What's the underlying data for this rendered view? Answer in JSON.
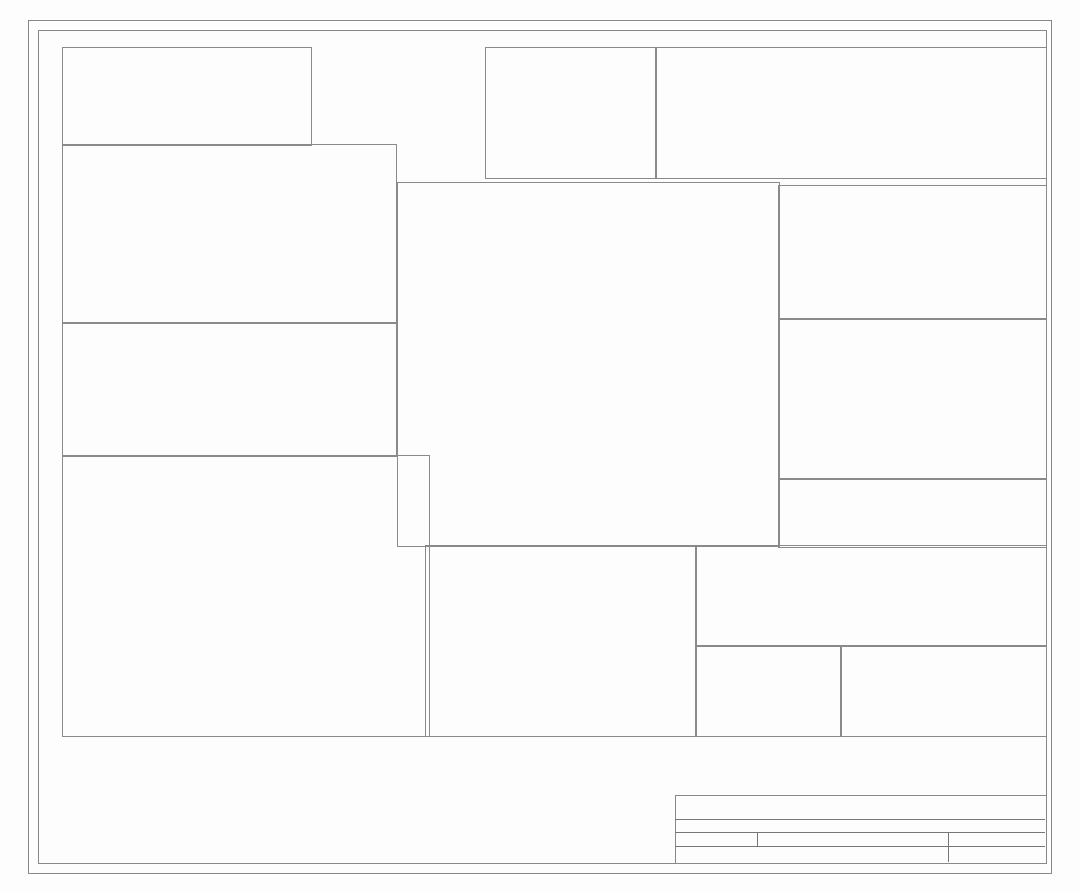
{
  "frame": {
    "cols": [
      "1",
      "2",
      "3",
      "4",
      "5",
      "6"
    ],
    "rows": [
      "A",
      "B",
      "C",
      "D",
      "E"
    ]
  },
  "title_block": {
    "sheet": "Sheet: /",
    "file": "File: STM32Duino开发板-G431Rx.kicad_sch",
    "title": "Title:",
    "size": "Size: User",
    "date": "Date:",
    "rev": "Rev:",
    "app": "KiCad E.D.A. 9.0.2",
    "id": "Id: 1/1"
  },
  "crystal": {
    "title": "晶振",
    "gnd": "GND",
    "c1": "C1",
    "c1v": "10pF",
    "osc_in": "OSC_IN",
    "x1": "X1",
    "x1v": "8MHz",
    "c2": "C2",
    "c2v": "10pF",
    "osc_out": "OSC_OUT",
    "c22": "C22",
    "c22v": "15pF",
    "osc32_in": "OSC32_IN",
    "x2": "X2",
    "x2v": "32.768kHz",
    "c23": "C23",
    "c23v": "15pF",
    "osc32_out": "OSC32_OUT"
  },
  "fuse": {
    "title": "电源保险丝",
    "vbus": "VBUS",
    "f1": "F1",
    "vusb": "VUSB"
  },
  "power": {
    "title": "电源部分",
    "dc2": "DC2",
    "p1": "1",
    "p3": "3",
    "p2": "2",
    "vin": "VIN",
    "d6": "D6",
    "vcc": "VCC",
    "c32": "C32",
    "c32v": "47uF",
    "u12": "U12",
    "u12pins": "VIN VOUT ADJ/GND",
    "n321": "3 2 1",
    "gnd": "GND",
    "pwr1": "PWR1",
    "r20": "R20",
    "r20v": "1.2kΩ",
    "p5v": "+5V",
    "c33": "C33",
    "c33v": "100nF",
    "c34": "C34",
    "c34v": "47uF",
    "c35": "C35",
    "c35v": "100nF",
    "c17": "C17",
    "c17v": "10uF",
    "c9": "C9",
    "c9v": "100nF",
    "q1": "Q1",
    "c18": "C18",
    "c18v": "10uF",
    "c13": "C13",
    "c13v": "100nF",
    "p33": "+3.3V"
  },
  "rf": {
    "title": "参考电压滤波",
    "p33": "+3.3V",
    "l1": "L1",
    "l1v": "10uH",
    "aref": "AREF",
    "c47": "C47",
    "c47v": "100nF",
    "u17": "U17",
    "p2": "2",
    "c3": "C3",
    "c3v": "100nF",
    "c40": "C40",
    "c40v": "1uF",
    "c41": "C41",
    "c41v": "1uF",
    "c42": "C42",
    "c42v": "100nF",
    "gnda": "GNDA",
    "l2": "L2",
    "l2v": "10uH",
    "c46": "C46",
    "c46v": "100nF",
    "gnd": "GND",
    "avdd": "AVDD",
    "r30": "R30"
  },
  "mf": {
    "title": "MCU滤波",
    "p33": "+3.3V",
    "gnd": "GND",
    "refs": [
      "C48",
      "C19",
      "C37",
      "C38",
      "C39",
      "C43",
      "C44"
    ],
    "vals": [
      "1uF",
      "10uF",
      "100nF",
      "100nF",
      "100nF",
      "100nF",
      "100nF"
    ]
  },
  "mcu": {
    "title": "MCU",
    "ref": "U16",
    "part": "STM32G431RBT6",
    "p33": "+3.3V",
    "left": [
      [
        "1",
        "VBAT",
        "",
        ""
      ],
      [
        "2",
        "PC13",
        "PC13",
        "p"
      ],
      [
        "3",
        "PC14-OSC32_IN",
        "OSC32_IN",
        "p"
      ],
      [
        "4",
        "PC15-OSC32_OUT",
        "OSC32_OUT",
        "p"
      ],
      [
        "5",
        "PF0-OSC_IN",
        "OSC_IN",
        "p"
      ],
      [
        "6",
        "PF1-OSC_OUT",
        "OSC_OUT",
        "p"
      ],
      [
        "7",
        "PG10-NRST",
        "RESET",
        "p"
      ],
      [
        "8",
        "PC0",
        "A0",
        "p"
      ],
      [
        "9",
        "PC1",
        "A1",
        "p"
      ],
      [
        "10",
        "PC2",
        "A2",
        "p"
      ],
      [
        "11",
        "PC3",
        "A3",
        "p"
      ],
      [
        "12",
        "PA0",
        "A4",
        "p"
      ],
      [
        "13",
        "PA1",
        "A5",
        "p"
      ],
      [
        "14",
        "PA2",
        "D1",
        "p"
      ],
      [
        "15",
        "VSS",
        "GND",
        "w"
      ],
      [
        "16",
        "VDD",
        "+3.3V",
        "w"
      ],
      [
        "17",
        "PA3",
        "D0",
        "p"
      ],
      [
        "18",
        "PA4",
        "D2",
        "p"
      ],
      [
        "19",
        "PA5",
        "D3",
        "p"
      ],
      [
        "20",
        "PA6",
        "D5",
        "p"
      ],
      [
        "21",
        "PA7",
        "D6",
        "p"
      ],
      [
        "22",
        "PC4",
        "D4",
        "p"
      ],
      [
        "23",
        "PC5",
        "D7",
        "p"
      ],
      [
        "24",
        "PB0",
        "WS2812",
        "p"
      ],
      [
        "25",
        "PB1",
        "D9",
        "p"
      ],
      [
        "26",
        "PB2",
        "D8",
        "p"
      ],
      [
        "27",
        "VSSA",
        "GNDA",
        "w"
      ],
      [
        "28",
        "VREF+",
        "AREF",
        "p"
      ],
      [
        "29",
        "VDDA",
        "AVDD",
        "p"
      ],
      [
        "30",
        "PB10",
        "D10",
        "p"
      ],
      [
        "31",
        "VSS",
        "GND",
        "w"
      ],
      [
        "32",
        "VDD",
        "+3.3V",
        "w"
      ]
    ],
    "right": [
      [
        "64",
        "VDD",
        "+3.3V",
        "w"
      ],
      [
        "63",
        "VSS",
        "GND",
        "w"
      ],
      [
        "62",
        "PB9",
        "",
        "x"
      ],
      [
        "61",
        "PB8-BOOT0",
        "BOOT0",
        "p"
      ],
      [
        "60",
        "PB7",
        "SDA3",
        "p"
      ],
      [
        "59",
        "PB6",
        "",
        "x"
      ],
      [
        "58",
        "PB5",
        "",
        "x"
      ],
      [
        "57",
        "PB4",
        "",
        "x"
      ],
      [
        "56",
        "PB3",
        "",
        "x"
      ],
      [
        "55",
        "PD2",
        "",
        "x"
      ],
      [
        "54",
        "PC12",
        "",
        "x"
      ],
      [
        "53",
        "PC11",
        "RX3",
        "p"
      ],
      [
        "52",
        "PC10",
        "TX3",
        "p"
      ],
      [
        "51",
        "PA15",
        "SCL3",
        "p"
      ],
      [
        "50",
        "PA14",
        "SWCLK",
        "p"
      ],
      [
        "49",
        "PA13",
        "SWDIO",
        "p"
      ],
      [
        "48",
        "VDD",
        "+3.3V",
        "w"
      ],
      [
        "47",
        "VSS",
        "GND",
        "w"
      ],
      [
        "46",
        "PA12",
        "USB_D+",
        "p"
      ],
      [
        "45",
        "PA11",
        "USB_D-",
        "p"
      ],
      [
        "44",
        "PA10",
        "RXD",
        "p"
      ],
      [
        "43",
        "PA9",
        "TXD",
        "p"
      ],
      [
        "42",
        "PA8",
        "SCL",
        "p"
      ],
      [
        "41",
        "PC9",
        "SDA",
        "p"
      ],
      [
        "40",
        "PC8",
        "",
        "x"
      ],
      [
        "39",
        "PC7",
        "",
        "x"
      ],
      [
        "38",
        "PC6",
        "",
        "x"
      ],
      [
        "37",
        "PB15",
        "MOSI",
        "p"
      ],
      [
        "36",
        "PB14",
        "MISO",
        "p"
      ],
      [
        "35",
        "PB13",
        "SCK",
        "p"
      ],
      [
        "34",
        "PB12",
        "",
        "x"
      ],
      [
        "33",
        "PB11",
        "",
        "x"
      ]
    ]
  },
  "tc": {
    "title": "TYPE-C接口",
    "ref": "USB1",
    "vbus": "VBUS",
    "gnd": "GND",
    "shell14": "14",
    "shell13": "13",
    "shell": "SHELL",
    "rows": [
      [
        "1",
        "GND",
        "n"
      ],
      [
        "2",
        "VBUS",
        "n"
      ],
      [
        "3",
        "SBU2",
        "x"
      ],
      [
        "4",
        "CC1",
        "n"
      ],
      [
        "5",
        "DN2",
        "n"
      ],
      [
        "6",
        "DP1",
        "n"
      ],
      [
        "7",
        "DN1",
        "n"
      ],
      [
        "8",
        "DP2",
        "n"
      ],
      [
        "9",
        "SBU1",
        "x"
      ],
      [
        "10",
        "CC2",
        "n"
      ],
      [
        "11",
        "VBUS",
        "n"
      ],
      [
        "12",
        "GND",
        "n"
      ]
    ],
    "r5": "R5",
    "r5v": "5.1kΩ",
    "r4": "R4",
    "r4v": "5.1kΩ",
    "r8": "R8",
    "r8v": "22Ω",
    "r7": "R7",
    "r7v": "22Ω",
    "chdm": "CH340C_D-",
    "chdp": "CH340C_D+",
    "usbdp": "USB_D+",
    "usbdm": "USB_D-"
  },
  "sel": {
    "title": "5V电压来源选择",
    "vcc": "VCC",
    "r16": "R16",
    "r16v": "10kΩ",
    "r15": "R15",
    "r15v": "10kΩ",
    "p33": "+3.3V",
    "u4a": "U4A",
    "p5v": "+5V",
    "pin2": "2",
    "pin3": "3",
    "pin1": "1",
    "pin8": "8",
    "pin4": "4",
    "minus": "−",
    "plus": "+",
    "vusb": "VUSB",
    "q2": "Q2",
    "q2v": "AO3401A"
  },
  "swd": {
    "title": "SWD  烧录接口",
    "d0": "D0",
    "r29": "R29",
    "r29v": "1kΩ",
    "swdio": "SWDIO",
    "r26": "R26",
    "r26v": "0Ω",
    "swclk": "SWCLK",
    "r27": "R27",
    "r27v": "0Ω",
    "h2": "H2",
    "nums": [
      "1",
      "2",
      "3",
      "4",
      "5",
      "6"
    ],
    "d1": "D1",
    "gnd": "GND"
  },
  "pd": {
    "title": "引脚定义(兼容 Arduino Uno R3 的接口)",
    "u15": "U15",
    "u5": "U5",
    "u14": "U14",
    "u6": "U6",
    "h8": "H8",
    "u7": "U7",
    "h7": "H7",
    "h1": "H1",
    "h3": "H3",
    "h4": "H4",
    "h5": "H5",
    "g1": [
      "SCL",
      "SDA",
      "AREF",
      "",
      "SCK",
      "MISO",
      "MOSI",
      "D10",
      "D9",
      "D8"
    ],
    "g2": [
      "D7",
      "D6",
      "D5",
      "D4",
      "D3",
      "D2",
      "D1",
      "D0"
    ],
    "g4": [
      "A0",
      "A1",
      "A2",
      "A3",
      "A4",
      "A5"
    ],
    "gnd": "GND",
    "p33": "+3.3V",
    "p5v": "+5V",
    "vin": "VIN",
    "reset": "RESET",
    "v33": "3.3V",
    "rx3": "RX3",
    "tx3": "TX3",
    "scl3": "SCL3",
    "sda3": "SDA3"
  },
  "ind": {
    "title": "指示灯",
    "p33": "+3.3V",
    "r17": "R17",
    "r17v": "2kΩ",
    "r18": "R18",
    "r18v": "2kΩ",
    "tx1": "TX1",
    "rx1": "RX1",
    "yellow": "黄色",
    "r21": "R21",
    "r21v": "1kΩ",
    "rxd": "RXD",
    "txd": "TXD",
    "sck": "SCK",
    "u4b": "U4B",
    "p5": "5",
    "p6": "6",
    "p7": "7",
    "plus": "+",
    "minus": "−",
    "r14": "R14",
    "r14v": "1kΩ",
    "led2": "LED2",
    "gnd": "GND",
    "r3": "R3",
    "r3v": "10K",
    "led1": "LED1",
    "green": "绿色",
    "pc13": "PC13",
    "led3": "LED3",
    "vdd": "VDD",
    "dout": "DOUT",
    "din": "DIN",
    "vss": "VSS",
    "ws2812": "WS2812",
    "part": "WS2812B-B/W",
    "n1": "1",
    "n2": "2",
    "n3": "3",
    "n4": "4"
  },
  "ser": {
    "title": "串口烧录",
    "ref": "U10",
    "gnd": "GND",
    "rxd": "RXD",
    "txd": "TXD",
    "c36": "C36",
    "c36v": "100nF",
    "chdp": "CH340C_D+",
    "chdm": "CH340C_D-",
    "c6": "C6",
    "c6v": "100nF",
    "c8": "C8",
    "c8v": "100nF",
    "reset": "RESET",
    "left": [
      [
        "1",
        "GND",
        "n"
      ],
      [
        "2",
        "TXD",
        "n"
      ],
      [
        "3",
        "RXD",
        "n"
      ],
      [
        "4",
        "V3",
        "n"
      ],
      [
        "5",
        "D+",
        "n"
      ],
      [
        "6",
        "D-",
        "n"
      ],
      [
        "7",
        "NC.",
        "x"
      ],
      [
        "8",
        "OUT#",
        "x"
      ]
    ],
    "right": [
      [
        "16",
        "VCC",
        "n"
      ],
      [
        "15",
        "R232",
        "x"
      ],
      [
        "14",
        "RTS#",
        "x"
      ],
      [
        "13",
        "DTR#",
        "n"
      ],
      [
        "12",
        "DCD#",
        "x"
      ],
      [
        "11",
        "RI#",
        "x"
      ],
      [
        "10",
        "DSR#",
        "x"
      ],
      [
        "9",
        "CTS#",
        "x"
      ]
    ]
  },
  "boot": {
    "title": "启动选择",
    "p33": "+3.3V",
    "sw1": "SW1",
    "sw1v": "BX-DS1.27-1PTP",
    "boot0": "BOOT0",
    "r28": "R28",
    "r28v": "10kΩ",
    "gnd": "GND",
    "n1": "1"
  },
  "rst": {
    "title": "复位",
    "ref": "RESET1",
    "part": "TS6631A4P",
    "reset": "RESET",
    "r19": "R19",
    "r19v": "10kΩ",
    "p33": "+3.3V",
    "gnd": "GND",
    "n1": "1",
    "n2": "2",
    "n3": "3",
    "n4": "4"
  }
}
